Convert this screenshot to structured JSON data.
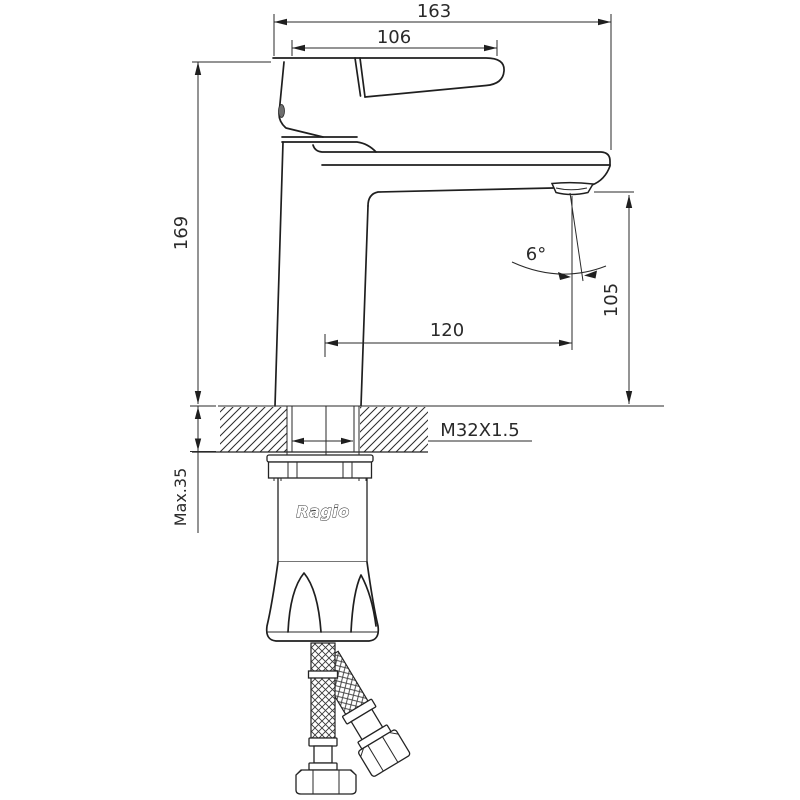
{
  "drawing": {
    "title": "basin-faucet-dimension-drawing",
    "brand_label": "Ragio",
    "colors": {
      "line": "#222222",
      "background": "#ffffff"
    },
    "dims": {
      "overall_length": "163",
      "handle_length": "106",
      "body_height": "169",
      "spout_height": "105",
      "spout_reach": "120",
      "stream_angle": "6°",
      "thread_spec": "M32X1.5",
      "max_deck_thickness": "Max.35"
    }
  }
}
